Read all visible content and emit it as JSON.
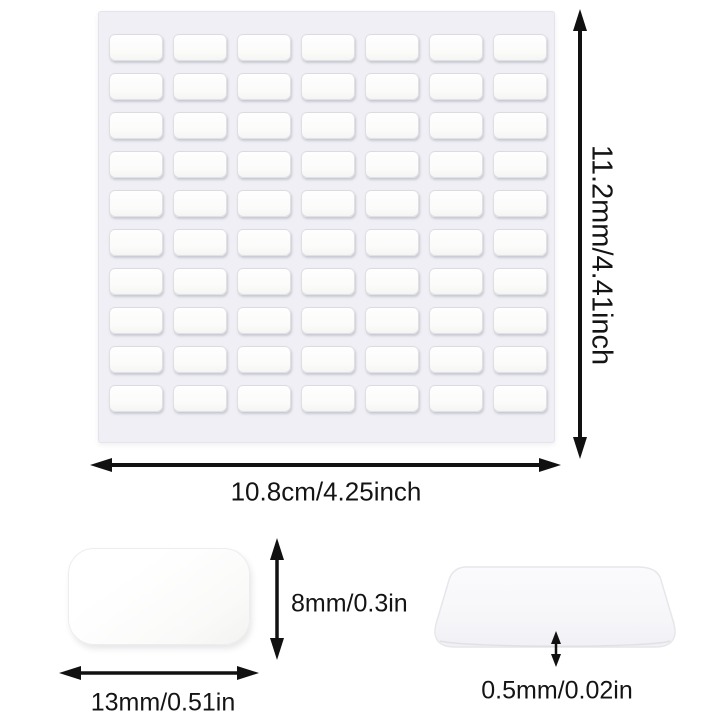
{
  "diagram": {
    "type": "product-dimension-diagram",
    "subject": "double-sided adhesive pad sheet"
  },
  "sheet": {
    "rows": 10,
    "cols": 7,
    "total_pads": 70,
    "height_label": "11.2mm/4.41inch",
    "width_label": "10.8cm/4.25inch"
  },
  "single_pad": {
    "height_label": "8mm/0.3in",
    "width_label": "13mm/0.51in"
  },
  "thin_pad": {
    "thickness_label": "0.5mm/0.02in"
  },
  "colors": {
    "background": "#ffffff",
    "sheet_surface": "#efeff5",
    "pad_fill": "#fbfbfa",
    "arrow_and_text": "#111111"
  }
}
